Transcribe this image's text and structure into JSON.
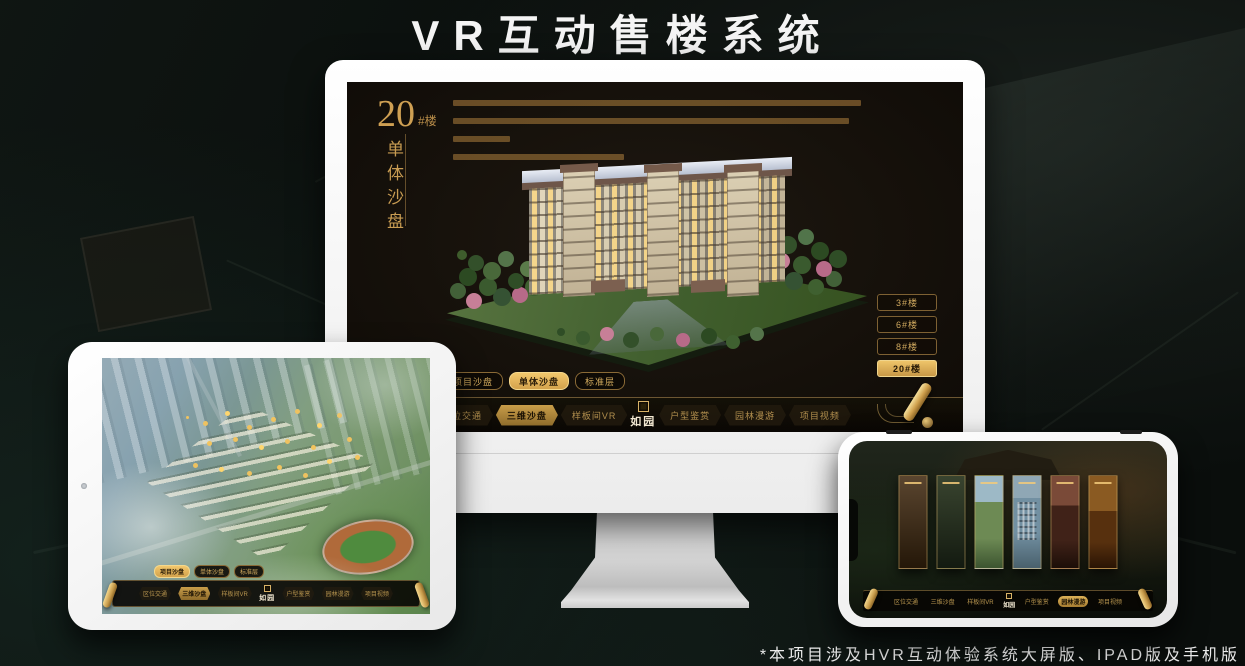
{
  "title": "VR互动售楼系统",
  "footnote": "*本项目涉及HVR互动体验系统大屏版、IPAD版及手机版",
  "logo": "如园",
  "nav_items": [
    "区位交通",
    "三维沙盘",
    "样板间VR",
    "户型鉴赏",
    "园林漫游",
    "项目视频"
  ],
  "tabs": [
    "项目沙盘",
    "单体沙盘",
    "标准层"
  ],
  "monitor": {
    "heading_number": "20",
    "heading_unit": "#楼",
    "heading_subtitle": "单体沙盘",
    "buildings": [
      "3#楼",
      "6#楼",
      "8#楼",
      "20#楼"
    ],
    "active_building": "20#楼",
    "active_tab": "单体沙盘",
    "active_nav": "三维沙盘"
  },
  "tablet": {
    "active_tab": "项目沙盘",
    "active_nav": "三维沙盘"
  },
  "phone": {
    "active_nav": "园林漫游"
  },
  "colors": {
    "gold": "#d2a75c",
    "gold_active": "#eec469",
    "screen_bg": "#16110b",
    "device_white": "#f5f5f5",
    "background": "#0a0e0c"
  }
}
